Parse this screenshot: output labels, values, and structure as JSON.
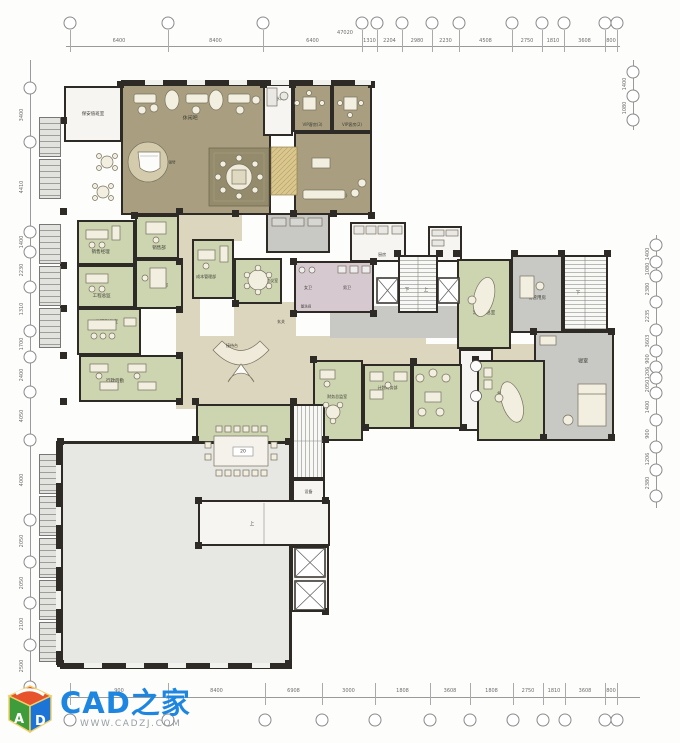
{
  "watermark": {
    "brand": "CAD之家",
    "url": "WWW.CADZJ.COM"
  },
  "colors": {
    "wall": "#2e2b26",
    "olive_room": "#a99f80",
    "green_room": "#ccd4b0",
    "corridor_beige": "#ddd6be",
    "wc_pink": "#d7c9d0",
    "grey_room": "#c8c8c4",
    "open_area": "#e7e7e3",
    "brand_blue": "#1d86e0",
    "logo_orange": "#e6532c",
    "logo_green": "#3f9c3a",
    "logo_blue": "#1b74d6"
  },
  "grid": {
    "top": {
      "line": {
        "x1": 66,
        "x2": 620,
        "y": 46
      },
      "bubble_y": 23,
      "bubbles_x": [
        70,
        168,
        263,
        362,
        377,
        402,
        432,
        459,
        512,
        542,
        564,
        605,
        617
      ],
      "values": [
        "6400",
        "8400",
        "6400",
        "1310",
        "2204",
        "2980",
        "2230",
        "4508",
        "2750",
        "1810",
        "3608",
        "800"
      ],
      "values_y": 41,
      "total": "47020",
      "total_x": 345,
      "total_y": 33
    },
    "bottom": {
      "line": {
        "x1": 66,
        "x2": 640,
        "y": 697
      },
      "bubble_y": 720,
      "bubbles_x": [
        70,
        168,
        265,
        322,
        375,
        430,
        470,
        513,
        543,
        565,
        605,
        617
      ],
      "values": [
        "900",
        "8400",
        "6908",
        "3000",
        "1808",
        "3608",
        "1808",
        "2750",
        "1810",
        "3608",
        "800"
      ],
      "values_y": 691
    },
    "left": {
      "line": {
        "y1": 60,
        "y2": 700,
        "x": 30
      },
      "bubble_x": 30,
      "bubbles_y": [
        88,
        142,
        232,
        252,
        287,
        331,
        357,
        392,
        440,
        520,
        562,
        603,
        645,
        687
      ],
      "values": [
        "3400",
        "4410",
        "1400",
        "2230",
        "1310",
        "1700",
        "2400",
        "4050",
        "4000",
        "2050",
        "2050",
        "2100",
        "2500"
      ],
      "values_x": 22
    },
    "right": {
      "line": {
        "y1": 235,
        "y2": 508,
        "x": 656
      },
      "bubble_x": 656,
      "bubbles_y": [
        245,
        262,
        276,
        302,
        330,
        351,
        367,
        378,
        393,
        420,
        447,
        470,
        496
      ],
      "values": [
        "1400",
        "1080",
        "2380",
        "2235",
        "3603",
        "900",
        "1206",
        "2050",
        "1400",
        "900",
        "1206",
        "2380"
      ],
      "values_x": 648
    },
    "right_top": {
      "line": {
        "y1": 60,
        "y2": 130,
        "x": 633
      },
      "bubble_x": 633,
      "bubbles_y": [
        72,
        96,
        120
      ],
      "values": [
        "1400",
        "1080"
      ],
      "values_x": 625
    }
  },
  "rooms": [
    {
      "n": "room-security",
      "l": "保安值班室",
      "x": 64,
      "y": 86,
      "w": 58,
      "h": 56,
      "f": "white",
      "fs": 4.5
    },
    {
      "n": "corridor-top",
      "x": 196,
      "y": 213,
      "w": 46,
      "h": 28,
      "f": "beige",
      "nb": true
    },
    {
      "n": "corridor-vertical",
      "x": 176,
      "y": 213,
      "w": 24,
      "h": 196,
      "f": "beige",
      "nb": true
    },
    {
      "n": "lobby-main",
      "x": 182,
      "y": 336,
      "w": 244,
      "h": 72,
      "f": "beige",
      "nb": true
    },
    {
      "n": "corridor-right",
      "x": 420,
      "y": 344,
      "w": 144,
      "h": 30,
      "f": "beige",
      "nb": true
    },
    {
      "n": "corridor-mid",
      "x": 234,
      "y": 302,
      "w": 62,
      "h": 36,
      "f": "beige",
      "nb": true
    },
    {
      "n": "hall-grey",
      "x": 330,
      "y": 306,
      "w": 128,
      "h": 32,
      "f": "grey2",
      "nb": true
    },
    {
      "n": "room-lounge",
      "l": "休闲吧",
      "x": 121,
      "y": 84,
      "w": 150,
      "h": 131,
      "f": "olive",
      "fs": 5,
      "lx": 46,
      "ly": 25
    },
    {
      "n": "room-tea",
      "l": "茶水间",
      "x": 263,
      "y": 84,
      "w": 30,
      "h": 52,
      "f": "white",
      "fs": 4,
      "lx": 50,
      "ly": 28
    },
    {
      "n": "room-vip3",
      "l": "VIP客房(3)",
      "x": 293,
      "y": 84,
      "w": 39,
      "h": 48,
      "f": "olive",
      "fs": 4,
      "lx": 50,
      "ly": 88
    },
    {
      "n": "room-vip2",
      "l": "VIP客房(2)",
      "x": 332,
      "y": 84,
      "w": 40,
      "h": 48,
      "f": "olive",
      "fs": 4,
      "lx": 50,
      "ly": 88
    },
    {
      "n": "room-vip1",
      "l": "VIP客房(1)",
      "x": 294,
      "y": 132,
      "w": 78,
      "h": 83,
      "f": "olive",
      "fs": 4,
      "lx": 56,
      "ly": 78
    },
    {
      "n": "room-sales-manager",
      "l": "销售经理",
      "x": 77,
      "y": 220,
      "w": 58,
      "h": 45,
      "f": "green",
      "fs": 4.5,
      "lx": 40,
      "ly": 72
    },
    {
      "n": "room-sales-dept",
      "l": "销售部",
      "x": 135,
      "y": 215,
      "w": 44,
      "h": 44,
      "f": "green",
      "fs": 4.5,
      "lx": 55,
      "ly": 78
    },
    {
      "n": "room-eng-director",
      "l": "工程总监",
      "x": 77,
      "y": 265,
      "w": 58,
      "h": 43,
      "f": "green",
      "fs": 4.5,
      "lx": 42,
      "ly": 75
    },
    {
      "n": "room-engineering",
      "l": "工程部",
      "x": 135,
      "y": 259,
      "w": 48,
      "h": 50,
      "f": "green",
      "fs": 4.5,
      "lx": 55,
      "ly": 55
    },
    {
      "n": "room-eng-deputy",
      "l": "工程副总室",
      "x": 77,
      "y": 308,
      "w": 64,
      "h": 47,
      "f": "green",
      "fs": 4.5,
      "lx": 46,
      "ly": 28
    },
    {
      "n": "room-admin",
      "l": "行政后勤",
      "x": 79,
      "y": 355,
      "w": 104,
      "h": 47,
      "f": "green",
      "fs": 4.5,
      "lx": 34,
      "ly": 55
    },
    {
      "n": "room-cost-mgmt",
      "l": "成本管理部",
      "x": 192,
      "y": 239,
      "w": 42,
      "h": 60,
      "f": "green",
      "fs": 4,
      "lx": 32,
      "ly": 64
    },
    {
      "n": "room-meeting-small",
      "l": "会议室",
      "x": 234,
      "y": 258,
      "w": 48,
      "h": 46,
      "f": "green",
      "fs": 4,
      "lx": 82,
      "ly": 50
    },
    {
      "n": "room-wc",
      "x": 294,
      "y": 261,
      "w": 80,
      "h": 52,
      "f": "pink"
    },
    {
      "n": "room-storage",
      "x": 266,
      "y": 213,
      "w": 64,
      "h": 40,
      "f": "grey2"
    },
    {
      "n": "room-kitchen",
      "l": "厨房",
      "x": 350,
      "y": 222,
      "w": 56,
      "h": 40,
      "f": "white",
      "fs": 4,
      "lx": 58,
      "ly": 86
    },
    {
      "n": "room-shelf",
      "x": 428,
      "y": 226,
      "w": 34,
      "h": 36,
      "f": "white"
    },
    {
      "n": "room-stair-mid",
      "x": 398,
      "y": 255,
      "w": 40,
      "h": 58,
      "f": "stairs-v"
    },
    {
      "n": "room-exec-deputy",
      "l": "常务副总室",
      "x": 457,
      "y": 259,
      "w": 54,
      "h": 90,
      "f": "green",
      "fs": 4.5,
      "lx": 50,
      "ly": 60
    },
    {
      "n": "room-property-mgmt",
      "l": "物管用房",
      "x": 511,
      "y": 255,
      "w": 52,
      "h": 78,
      "f": "grey2",
      "fs": 4.5,
      "lx": 50,
      "ly": 56
    },
    {
      "n": "room-stair-right",
      "x": 563,
      "y": 255,
      "w": 45,
      "h": 76,
      "f": "stairs-v"
    },
    {
      "n": "room-bedroom",
      "l": "寝室",
      "x": 534,
      "y": 331,
      "w": 80,
      "h": 110,
      "f": "grey2",
      "fs": 5,
      "lx": 62,
      "ly": 26
    },
    {
      "n": "room-vestibule",
      "x": 459,
      "y": 349,
      "w": 34,
      "h": 82,
      "f": "white"
    },
    {
      "n": "room-finance-director",
      "l": "财务总监室",
      "x": 313,
      "y": 360,
      "w": 50,
      "h": 81,
      "f": "green",
      "fs": 4,
      "lx": 48,
      "ly": 46
    },
    {
      "n": "room-finance-dept",
      "l": "计划财务部",
      "x": 363,
      "y": 364,
      "w": 49,
      "h": 65,
      "f": "green",
      "fs": 4,
      "lx": 50,
      "ly": 36
    },
    {
      "n": "room-lounge-small",
      "x": 412,
      "y": 364,
      "w": 50,
      "h": 65,
      "f": "green"
    },
    {
      "n": "room-gm-office",
      "l": "总经理室",
      "x": 477,
      "y": 360,
      "w": 68,
      "h": 81,
      "f": "green",
      "fs": 4.5,
      "lx": 42,
      "ly": 42
    },
    {
      "n": "room-meeting-large",
      "l": "会议室",
      "x": 196,
      "y": 404,
      "w": 96,
      "h": 97,
      "f": "green",
      "fs": 4.5,
      "lx": 80,
      "ly": 50
    },
    {
      "n": "room-stair-bottom",
      "x": 292,
      "y": 404,
      "w": 33,
      "h": 75,
      "f": "stairs-h"
    },
    {
      "n": "room-equipment",
      "l": "设备",
      "x": 292,
      "y": 479,
      "w": 33,
      "h": 25,
      "f": "white",
      "fs": 4,
      "lx": 50,
      "ly": 50
    },
    {
      "n": "area-open",
      "x": 60,
      "y": 441,
      "w": 232,
      "h": 228,
      "f": "lightgrey",
      "bw": 3
    },
    {
      "n": "room-stairhall",
      "x": 198,
      "y": 500,
      "w": 132,
      "h": 46,
      "f": "white"
    },
    {
      "n": "room-elevator-shaft",
      "x": 291,
      "y": 546,
      "w": 38,
      "h": 66,
      "f": "white"
    }
  ],
  "floating_labels": [
    {
      "t": "下",
      "x": 407,
      "y": 290,
      "fs": 4.5
    },
    {
      "t": "上",
      "x": 426,
      "y": 290,
      "fs": 4.5
    },
    {
      "t": "下",
      "x": 578,
      "y": 293,
      "fs": 4.5
    },
    {
      "t": "上",
      "x": 252,
      "y": 524,
      "fs": 4.5
    },
    {
      "t": "20",
      "x": 243,
      "y": 452,
      "fs": 4.5
    },
    {
      "t": "女卫",
      "x": 308,
      "y": 288,
      "fs": 4
    },
    {
      "t": "男卫",
      "x": 347,
      "y": 288,
      "fs": 4
    },
    {
      "t": "盥洗间",
      "x": 306,
      "y": 307,
      "fs": 3.5
    },
    {
      "t": "钢琴",
      "x": 172,
      "y": 163,
      "fs": 3.5
    },
    {
      "t": "接待台",
      "x": 232,
      "y": 346,
      "fs": 4
    },
    {
      "t": "玄关",
      "x": 281,
      "y": 322,
      "fs": 4
    }
  ],
  "piers": [
    [
      117,
      81
    ],
    [
      260,
      81
    ],
    [
      289,
      81
    ],
    [
      368,
      81
    ],
    [
      60,
      117
    ],
    [
      60,
      208
    ],
    [
      131,
      212
    ],
    [
      176,
      208
    ],
    [
      232,
      210
    ],
    [
      290,
      210
    ],
    [
      330,
      210
    ],
    [
      368,
      212
    ],
    [
      60,
      262
    ],
    [
      60,
      305
    ],
    [
      60,
      352
    ],
    [
      176,
      258
    ],
    [
      176,
      306
    ],
    [
      176,
      352
    ],
    [
      394,
      250
    ],
    [
      436,
      250
    ],
    [
      453,
      250
    ],
    [
      511,
      250
    ],
    [
      558,
      250
    ],
    [
      604,
      250
    ],
    [
      60,
      398
    ],
    [
      176,
      398
    ],
    [
      232,
      300
    ],
    [
      290,
      258
    ],
    [
      290,
      310
    ],
    [
      370,
      258
    ],
    [
      370,
      310
    ],
    [
      310,
      356
    ],
    [
      410,
      358
    ],
    [
      472,
      356
    ],
    [
      540,
      434
    ],
    [
      608,
      434
    ],
    [
      192,
      398
    ],
    [
      290,
      398
    ],
    [
      192,
      436
    ],
    [
      322,
      436
    ],
    [
      362,
      424
    ],
    [
      460,
      424
    ],
    [
      57,
      438
    ],
    [
      285,
      438
    ],
    [
      57,
      660
    ],
    [
      285,
      660
    ],
    [
      195,
      497
    ],
    [
      322,
      497
    ],
    [
      195,
      542
    ],
    [
      322,
      608
    ],
    [
      530,
      328
    ],
    [
      608,
      328
    ]
  ],
  "strips": {
    "x": 39,
    "w": 22,
    "h": 40,
    "upper_y": [
      117,
      159,
      224,
      266,
      308
    ],
    "lower_y": [
      454,
      496,
      538,
      580,
      622
    ]
  },
  "window_walls": {
    "top": {
      "x": 121,
      "y": 80,
      "w": 250
    },
    "bottom": {
      "x": 60,
      "y": 663,
      "w": 232
    },
    "left": {
      "x": 56,
      "y": 441,
      "h": 224
    }
  }
}
